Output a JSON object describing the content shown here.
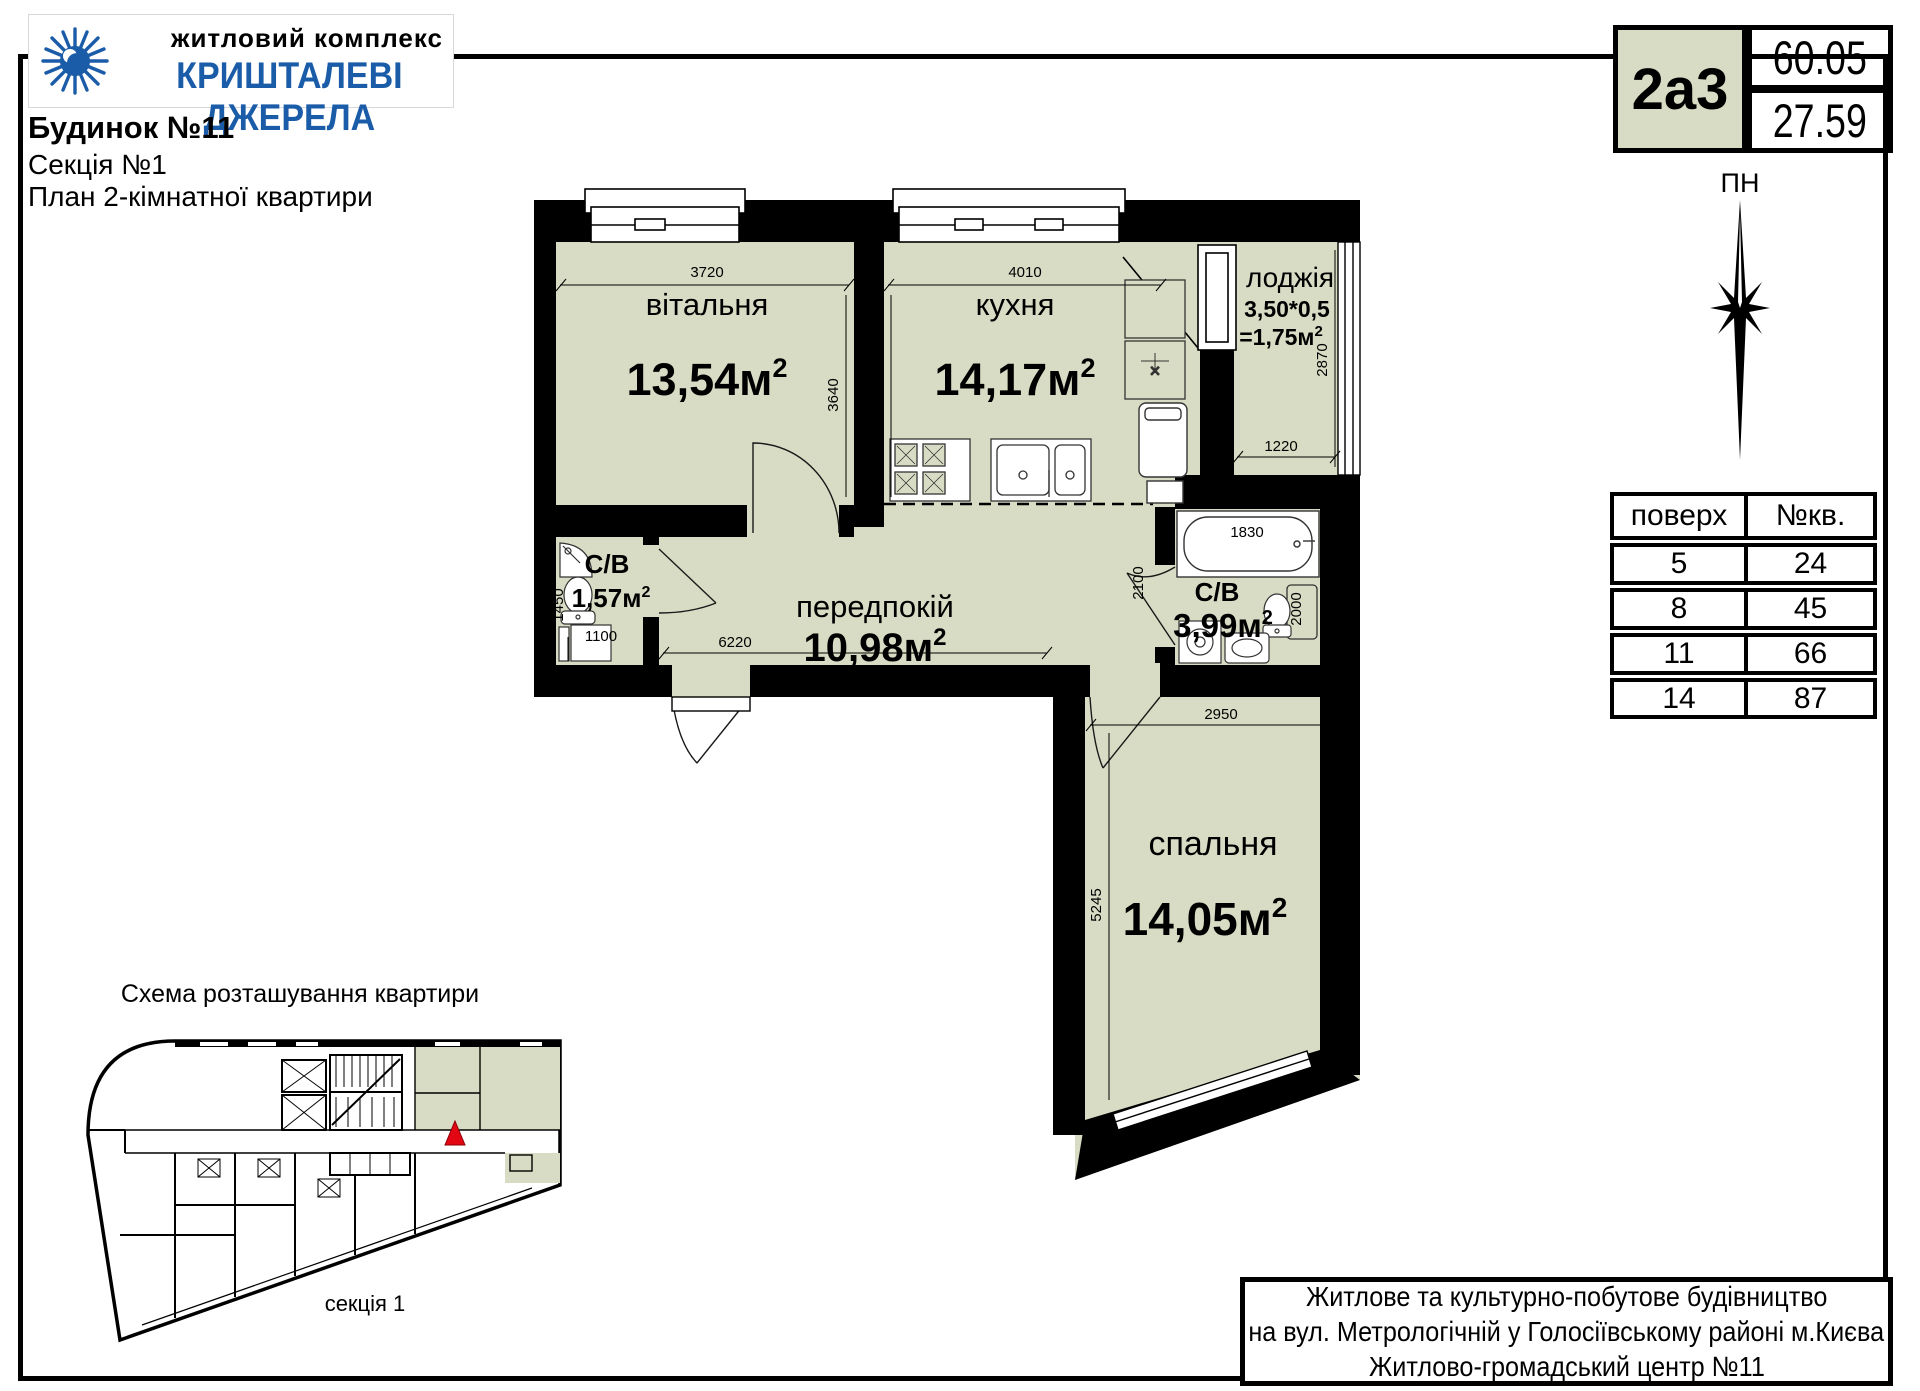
{
  "header": {
    "complex_label": "житловий комплекс",
    "complex_name": "КРИШТАЛЕВІ ДЖЕРЕЛА",
    "building": "Будинок №11",
    "section": "Секція №1",
    "plan_title": "План 2-кімнатної квартири"
  },
  "unit_card": {
    "code": "2а3",
    "total_area": "60.05",
    "living_area": "27.59"
  },
  "compass": {
    "label": "ПН"
  },
  "floors_table": {
    "headers": [
      "поверх",
      "№кв."
    ],
    "rows": [
      [
        "5",
        "24"
      ],
      [
        "8",
        "45"
      ],
      [
        "11",
        "66"
      ],
      [
        "14",
        "87"
      ]
    ]
  },
  "plan": {
    "unit": "м",
    "sup": "2",
    "rooms": {
      "living": {
        "name": "вітальня",
        "area": "13,54"
      },
      "kitchen": {
        "name": "кухня",
        "area": "14,17"
      },
      "loggia": {
        "name": "лоджія",
        "formula": "3,50*0,5",
        "area": "=1,75"
      },
      "bath1": {
        "name": "С/В",
        "area": "1,57"
      },
      "hall": {
        "name": "передпокій",
        "area": "10,98"
      },
      "bath2": {
        "name": "С/В",
        "area": "3,99"
      },
      "bedroom": {
        "name": "спальня",
        "area": "14,05"
      }
    },
    "dims": {
      "living_w": "3720",
      "kitchen_w": "4010",
      "living_h": "3640",
      "kitchen_h": "3740",
      "loggia_h": "2870",
      "loggia_w": "1220",
      "bath1_h": "1450",
      "bath1_w": "1100",
      "hall_w": "6220",
      "bath2_h_left": "2100",
      "tub_w": "1830",
      "bath2_h_right": "2000",
      "bedroom_w": "2950",
      "bedroom_h": "5245"
    }
  },
  "schema": {
    "title": "Схема розташування квартири",
    "section_label": "секція 1"
  },
  "footer": {
    "line1": "Житлове та культурно-побутове будівництво",
    "line2": "на вул. Метрологічній у Голосіївському районі м.Києва",
    "line3": "Житлово-громадський центр №11"
  },
  "colors": {
    "room_fill": "#d9dcc4",
    "accent_blue": "#1b5ca8",
    "marker_red": "#e30613"
  }
}
